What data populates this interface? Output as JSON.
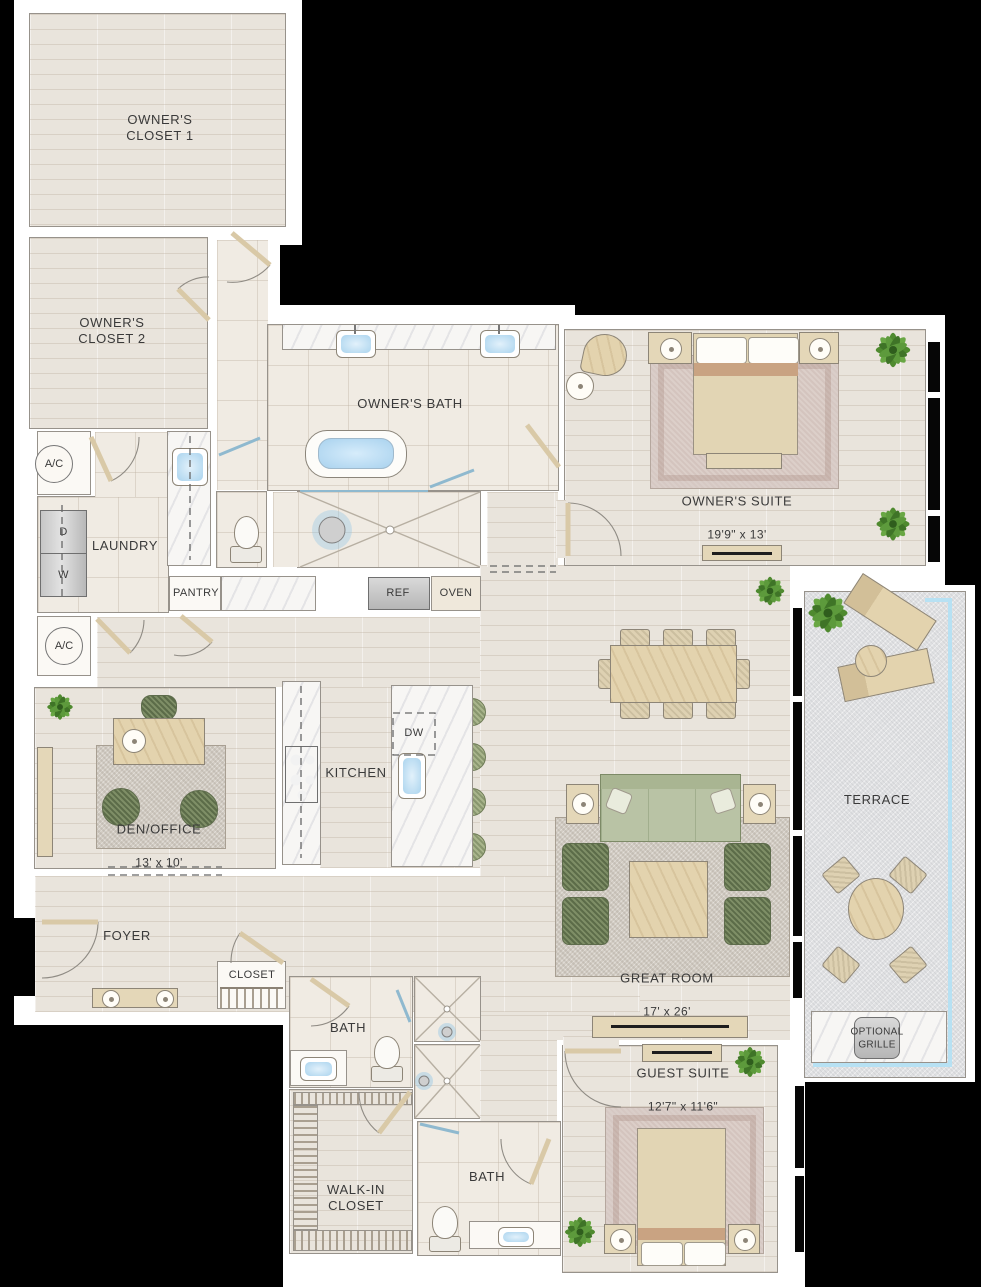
{
  "colors": {
    "background": "#000000",
    "wall": "#ffffff",
    "wood_floor": "#e9e4dc",
    "tile_floor": "#f0ebe3",
    "terrace_floor": "#e0e1e3",
    "water_blue": "#bfe0f5",
    "glass_blue": "#b7e1f3",
    "plant_green": "#4f8a2f",
    "upholstery_green": "#7e8e66",
    "furniture_tan": "#e4d7b8"
  },
  "rooms": {
    "owners_closet_1": {
      "label": "OWNER'S\nCLOSET 1"
    },
    "owners_closet_2": {
      "label": "OWNER'S\nCLOSET 2"
    },
    "owners_bath": {
      "label": "OWNER'S BATH"
    },
    "owners_suite": {
      "label": "OWNER'S SUITE",
      "dims": "19'9\" x 13'"
    },
    "laundry": {
      "label": "LAUNDRY"
    },
    "pantry": {
      "label": "PANTRY"
    },
    "kitchen": {
      "label": "KITCHEN"
    },
    "den_office": {
      "label": "DEN/OFFICE",
      "dims": "13' x 10'"
    },
    "foyer": {
      "label": "FOYER"
    },
    "foyer_closet": {
      "label": "CLOSET"
    },
    "bath_upper": {
      "label": "BATH"
    },
    "bath_lower": {
      "label": "BATH"
    },
    "walk_in_closet": {
      "label": "WALK-IN\nCLOSET"
    },
    "great_room": {
      "label": "GREAT ROOM",
      "dims": "17' x 26'"
    },
    "guest_suite": {
      "label": "GUEST SUITE",
      "dims": "12'7\" x 11'6\""
    },
    "terrace": {
      "label": "TERRACE"
    }
  },
  "fixtures": {
    "ac": "A/C",
    "dryer": "D",
    "washer": "W",
    "refrigerator": "REF",
    "oven": "OVEN",
    "dishwasher": "DW",
    "optional_grille": "OPTIONAL\nGRILLE"
  }
}
